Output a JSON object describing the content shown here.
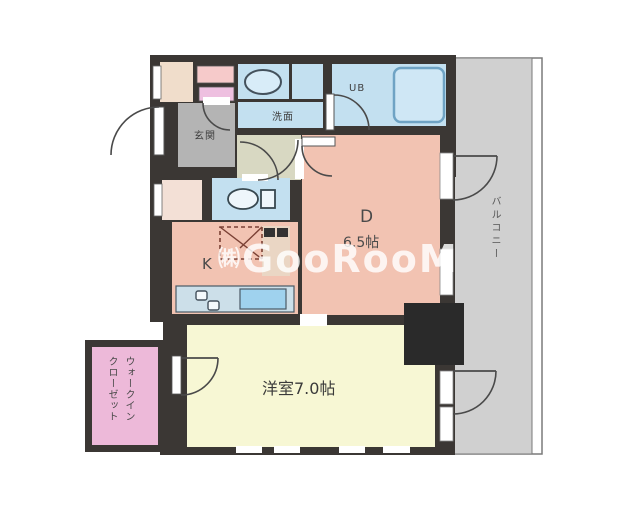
{
  "watermark": {
    "prefix": "㈱",
    "text": "GooRooM"
  },
  "rooms": {
    "entrance": {
      "label": "玄関"
    },
    "washroom": {
      "label": "洗面"
    },
    "unit_bath": {
      "label": "UB"
    },
    "dining": {
      "label": "D",
      "size": "6.5帖"
    },
    "kitchen": {
      "label": "K"
    },
    "western_room": {
      "label": "洋室7.0帖"
    },
    "balcony": {
      "label": "バルコニー"
    },
    "walk_in_closet": {
      "line1": "ウォークイン",
      "line2": "クローゼット"
    }
  },
  "colors": {
    "wall": "#3b3734",
    "room_pink": "#f2c3b2",
    "room_yellow": "#f7f7d4",
    "room_blue": "#c3e0f0",
    "wic_pink": "#edb9d9",
    "entrance_gray": "#b4b4b4",
    "hall_olive": "#d8d8c2",
    "balcony_gray": "#d0d0d0",
    "closet_beige": "#f0ddcb"
  }
}
